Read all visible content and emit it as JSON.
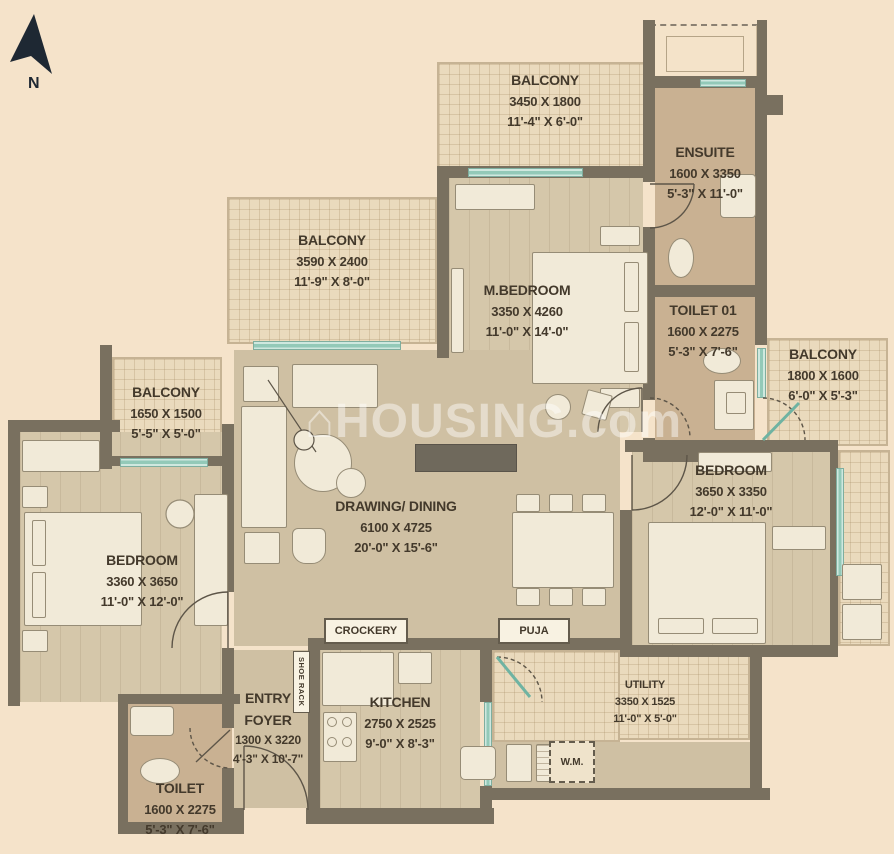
{
  "meta": {
    "north_label": "N",
    "watermark_text": "HOUSING.com",
    "watermark_icon": "⌂"
  },
  "rooms": {
    "balcony_top": {
      "name": "BALCONY",
      "mm": "3450 X 1800",
      "ft": "11'-4\" X 6'-0\""
    },
    "ensuite": {
      "name": "ENSUITE",
      "mm": "1600 X 3350",
      "ft": "5'-3\" X 11'-0\""
    },
    "balcony_upper_left": {
      "name": "BALCONY",
      "mm": "3590 X 2400",
      "ft": "11'-9\" X 8'-0\""
    },
    "master_bedroom": {
      "name": "M.BEDROOM",
      "mm": "3350 X 4260",
      "ft": "11'-0\" X 14'-0\""
    },
    "toilet_01": {
      "name": "TOILET 01",
      "mm": "1600 X 2275",
      "ft": "5'-3\" X 7'-6\""
    },
    "balcony_right": {
      "name": "BALCONY",
      "mm": "1800 X 1600",
      "ft": "6'-0\" X 5'-3\""
    },
    "balcony_left": {
      "name": "BALCONY",
      "mm": "1650 X 1500",
      "ft": "5'-5\" X 5'-0\""
    },
    "bedroom_left": {
      "name": "BEDROOM",
      "mm": "3360 X 3650",
      "ft": "11'-0\" X 12'-0\""
    },
    "drawing_dining": {
      "name": "DRAWING/ DINING",
      "mm": "6100 X 4725",
      "ft": "20'-0\" X 15'-6\""
    },
    "bedroom_right": {
      "name": "BEDROOM",
      "mm": "3650 X 3350",
      "ft": "12'-0\" X 11'-0\""
    },
    "kitchen": {
      "name": "KITCHEN",
      "mm": "2750 X 2525",
      "ft": "9'-0\" X 8'-3\""
    },
    "utility": {
      "name": "UTILITY",
      "mm": "3350 X 1525",
      "ft": "11'-0\" X 5'-0\""
    },
    "entry_foyer": {
      "name": "ENTRY FOYER",
      "mm": "1300 X 3220",
      "ft": "4'-3\" X 10'-7\""
    },
    "toilet": {
      "name": "TOILET",
      "mm": "1600 X 2275",
      "ft": "5'-3\" X 7'-6\""
    }
  },
  "labels": {
    "crockery": "CROCKERY",
    "puja": "PUJA",
    "shoe_rack": "SHOE RACK",
    "washing_machine": "W.M."
  },
  "colors": {
    "background": "#f5e3ca",
    "wall": "#79705f",
    "floor": "#cfc0a3",
    "floor_dark": "#c9b192",
    "balcony_floor": "#eadabd",
    "glass": "#93c9b8",
    "text": "#43392b",
    "watermark": "rgba(255,255,255,0.45)"
  }
}
